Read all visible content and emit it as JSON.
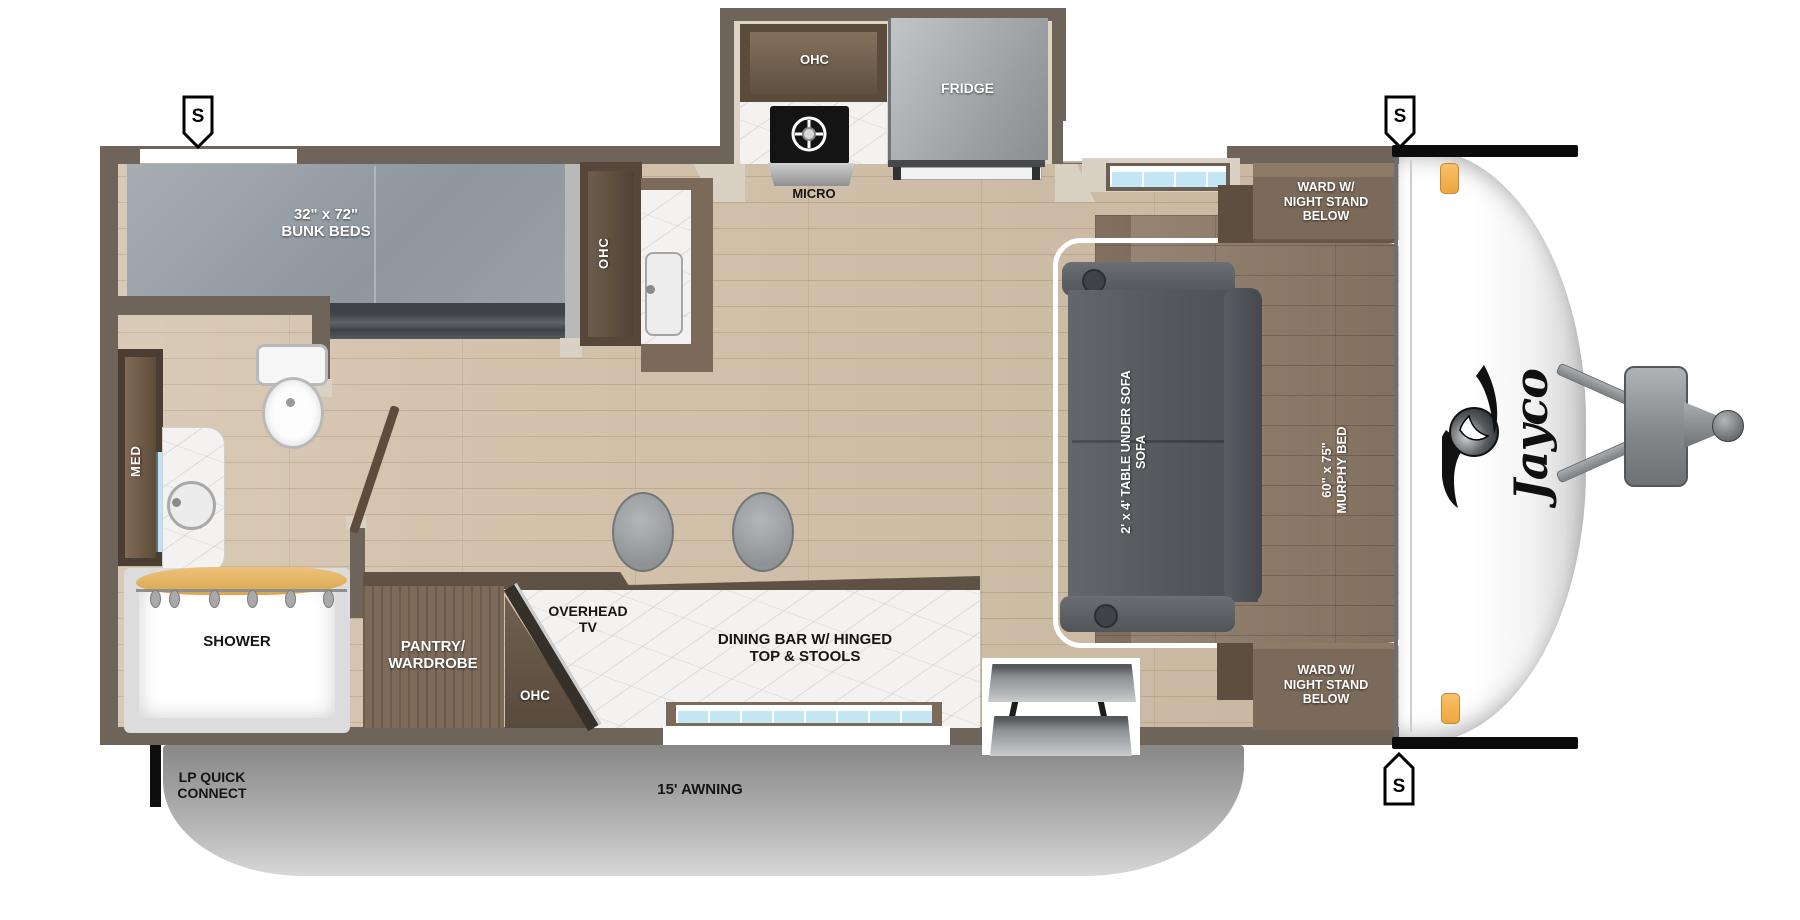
{
  "title": "Jayco travel trailer floorplan",
  "brand": {
    "logo_text": "Jayco"
  },
  "markers": {
    "speaker": "S"
  },
  "labels": {
    "bunk": {
      "line1": "32\" x 72\"",
      "line2": "BUNK BEDS"
    },
    "bunk_ohc": "OHC",
    "kitchen": {
      "ohc": "OHC",
      "fridge": "FRIDGE",
      "micro": "MICRO"
    },
    "bath": {
      "med": "MED",
      "shower": "SHOWER"
    },
    "pantry": {
      "line1": "PANTRY/",
      "line2": "WARDROBE"
    },
    "tv_area": {
      "ohc": "OHC",
      "line1": "OVERHEAD",
      "line2": "TV"
    },
    "dining": {
      "line1": "DINING BAR W/ HINGED",
      "line2": "TOP & STOOLS"
    },
    "sofa": {
      "line1": "2' x 4' TABLE UNDER SOFA",
      "line2": "SOFA"
    },
    "murphy": {
      "line1": "60\" x 75\"",
      "line2": "MURPHY BED"
    },
    "ward_top": {
      "line1": "WARD W/",
      "line2": "NIGHT STAND",
      "line3": "BELOW"
    },
    "ward_bottom": {
      "line1": "WARD W/",
      "line2": "NIGHT STAND",
      "line3": "BELOW"
    },
    "awning": "15' AWNING",
    "lp": {
      "line1": "LP QUICK",
      "line2": "CONNECT"
    }
  },
  "colors": {
    "wall": "#6f6459",
    "floor": "#d3c2ac",
    "murphy_wood": "#8d7a67",
    "slide_floor": "#ddd4c6",
    "mattress": "#9aa1a8",
    "sofa": "#5a5e62",
    "marble": "#f3f2f0",
    "window_glass": "#c3e6f4",
    "awning": "#b5b5b5",
    "clearance_light": "#f3b14e",
    "cap_band": "#0c0c0c"
  }
}
